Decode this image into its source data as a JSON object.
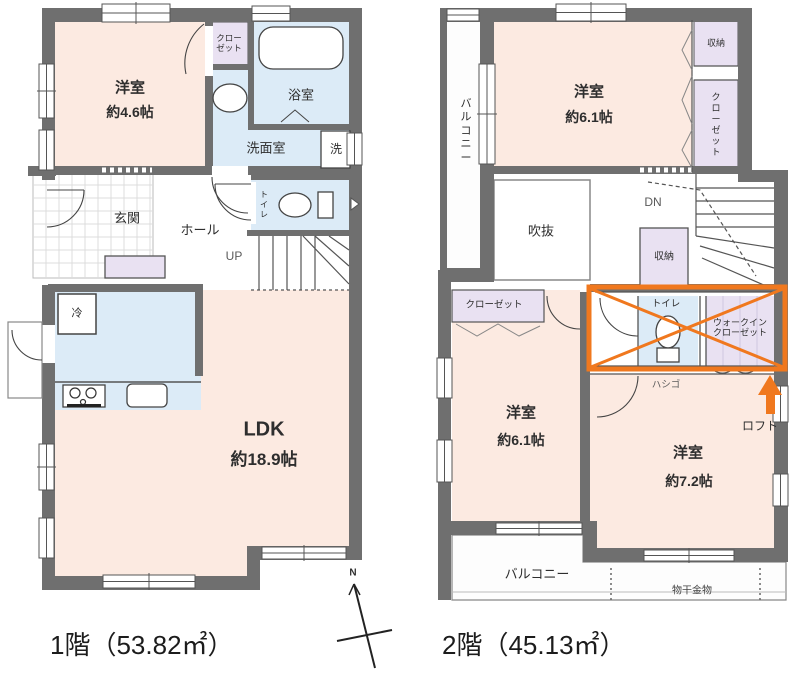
{
  "floor1": {
    "title": "1階（53.82㎡）",
    "labels": {
      "room46_name": "洋室",
      "room46_size": "約4.6帖",
      "closet": "クローゼット",
      "bath": "浴室",
      "washroom": "洗面室",
      "washer": "洗",
      "toilet": "トイレ",
      "genkan": "玄関",
      "hall": "ホール",
      "up": "UP",
      "fridge": "冷",
      "ldk_name": "LDK",
      "ldk_size": "約18.9帖"
    }
  },
  "floor2": {
    "title": "2階（45.13㎡）",
    "labels": {
      "balcony_left": "バルコニー",
      "room_top_name": "洋室",
      "room_top_size": "約6.1帖",
      "storage_top": "収納",
      "closet_right": "クローゼット",
      "void": "吹抜",
      "dn": "DN",
      "storage_mid": "収納",
      "closet_left": "クローゼット",
      "toilet": "トイレ",
      "wic": "ウォークインクローゼット",
      "ladder": "ハシゴ",
      "loft": "ロフト",
      "room_bl_name": "洋室",
      "room_bl_size": "約6.1帖",
      "room_br_name": "洋室",
      "room_br_size": "約7.2帖",
      "balcony_bottom": "バルコニー",
      "hanger": "物干金物"
    }
  },
  "compass": {
    "north": "N"
  },
  "colors": {
    "wall": "#6f6f6f",
    "room_pink": "#fceae1",
    "wet_blue": "#dcebf7",
    "closet_purple": "#e9e1f2",
    "highlight_orange": "#f0781e"
  }
}
